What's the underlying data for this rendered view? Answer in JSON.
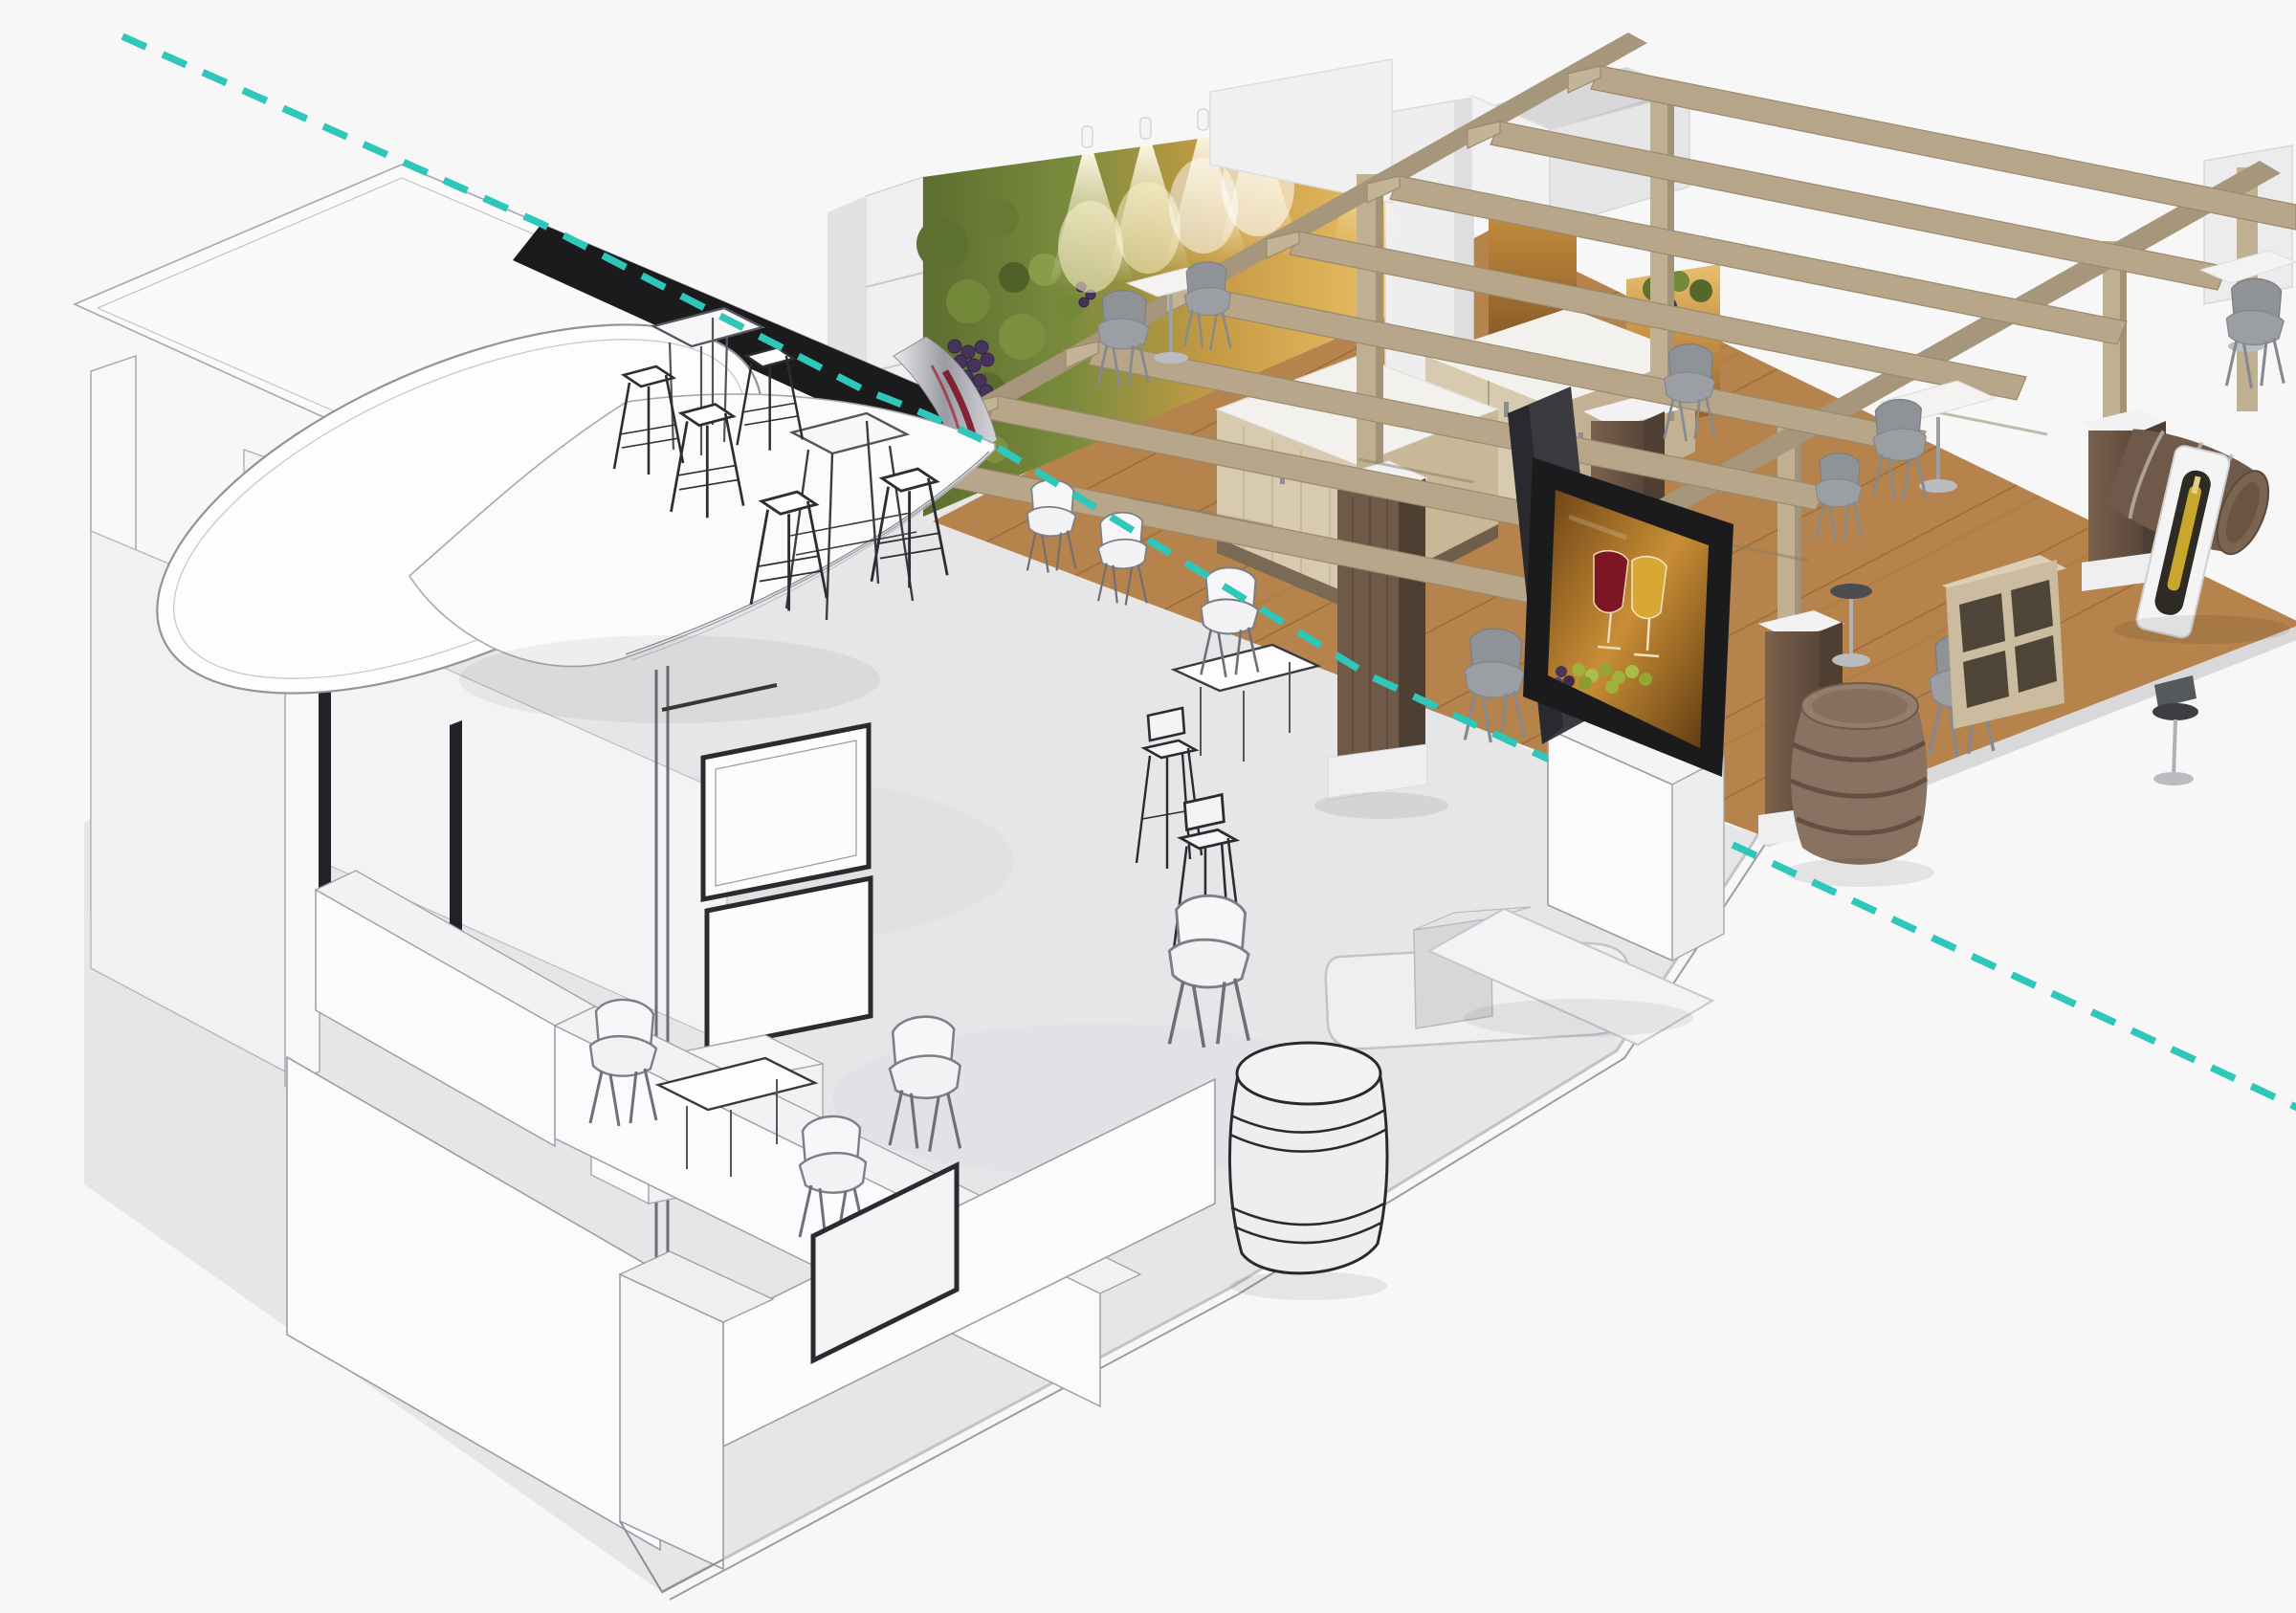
{
  "scene": {
    "type": "3d-architectural-render",
    "subject": "Exhibition booth concept visualization split diagonally: white wireframe sketch (lower left) transitioning to full color photorealistic render (upper right)",
    "left_half": "wireframe sketch booth",
    "right_half": "rendered wine-themed booth",
    "divider": {
      "style": "dashed-diagonal",
      "color": "#2fc7b9"
    }
  },
  "colors": {
    "background": "#f7f7f8",
    "accent_teal": "#2fc7b9",
    "sketch_floor": "#e6e6e9",
    "sketch_fill": "#fbfbfd",
    "sketch_shade": "#ededf0",
    "sketch_line": "#a7a7ad",
    "sketch_dark": "#2b2b2f",
    "canopy_black": "#1b1b1e",
    "wood_floor": "#b5834b",
    "wood_floor_dark": "#9a6a38",
    "plank_line": "#8a5c30",
    "pergola_wood": "#b7a689",
    "pergola_wood_dark": "#a6967b",
    "pergola_wood_light": "#c4b496",
    "walnut": "#6f5948",
    "walnut_dark": "#594739",
    "cabinet_wood": "#d8cab0",
    "cabinet_wood_shade": "#c2b193",
    "counter_top": "#f2f1ee",
    "wall_white": "#eeeeef",
    "vine_green": "#7c8c3e",
    "vine_green_dark": "#55682c",
    "vine_amber": "#dfae55",
    "grape_purple": "#46325a",
    "tv_black": "#1b1b1e",
    "tv_slab_grey": "#3a3a3f",
    "screen_amber": "#b87c28",
    "wine_red": "#7d1523",
    "wine_white": "#d9a834",
    "grape_green": "#9eb13c",
    "chair_grey": "#9b9ea3",
    "chair_grey_dark": "#8f9297",
    "chrome": "#aeb2b8",
    "barrel_brown": "#8a7262",
    "barrel_dark": "#6e594a",
    "bottle_gold": "#c9a62c",
    "glow_warm": "#fff3cf"
  },
  "objects": {
    "divider": [
      "teal-dashed-split-line"
    ],
    "sketch_side": [
      "sketch-canopy-roof",
      "sketch-oval-sign",
      "sketch-curved-sail-canopy",
      "sketch-columns",
      "sketch-bar-tables",
      "sketch-wire-stools",
      "sketch-hanging-display",
      "sketch-meeting-room",
      "sketch-reception-counter",
      "sketch-wireframe-barrel",
      "sketch-chairs",
      "sketch-platform-step",
      "sketch-floor"
    ],
    "render_side": [
      "wood-floor",
      "vineyard-graphic-wall",
      "wall-spotlights",
      "white-shelving-unit",
      "bar-counter",
      "back-cabinet",
      "walnut-pedestals",
      "wood-posts",
      "pergola-beams",
      "storage-room-box",
      "amber-graphic-panels",
      "tv-totem-with-wine-screen",
      "grey-shell-chairs",
      "white-bistro-tables",
      "bar-stools",
      "standing-wine-barrel",
      "lying-wine-barrel",
      "wine-bottle-display-stand",
      "cube-shelf"
    ]
  }
}
